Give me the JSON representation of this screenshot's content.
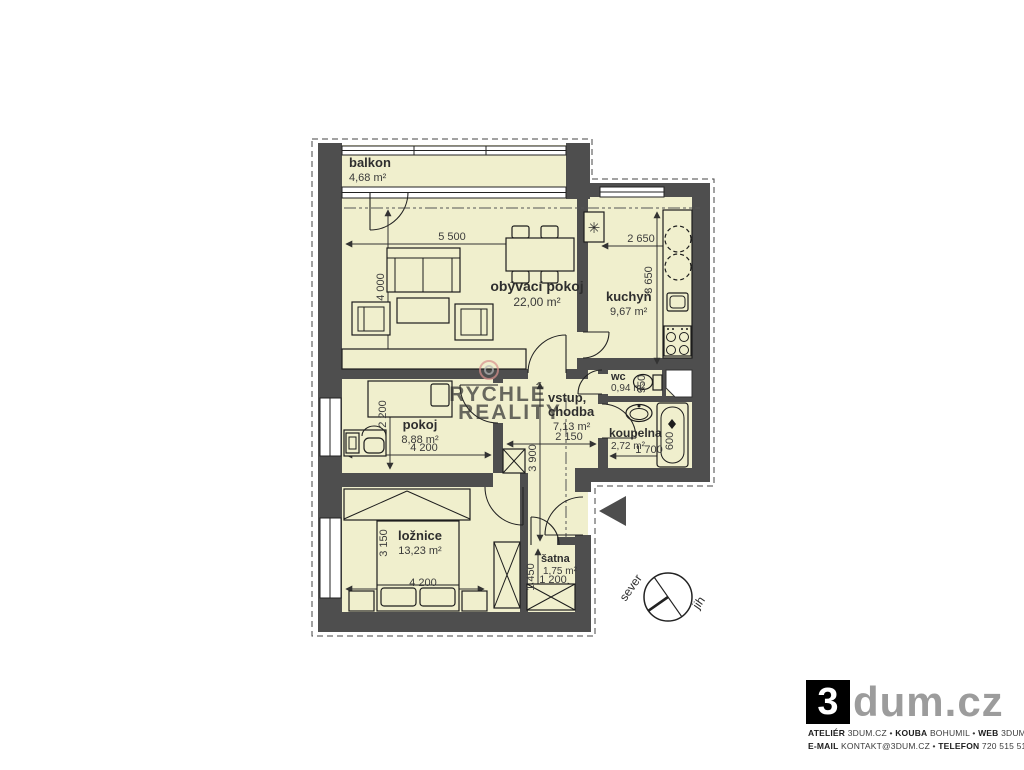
{
  "plan": {
    "balkon": {
      "name": "balkon",
      "area": "4,68 m²"
    },
    "obyvaci": {
      "name": "obývací pokoj",
      "area": "22,00 m²",
      "dim_w": "5 500",
      "dim_h": "4 000"
    },
    "kuchyn": {
      "name": "kuchyň",
      "area": "9,67 m²",
      "dim_w": "2 650",
      "dim_h": "3 650"
    },
    "wc": {
      "name": "wc",
      "area": "0,94 m²",
      "dim_h": "950"
    },
    "koupelna": {
      "name": "koupelna",
      "area": "2,72 m²",
      "dim_w": "1 700",
      "dim_tub": "600"
    },
    "pokoj": {
      "name": "pokoj",
      "area": "8,88 m²",
      "dim_w": "4 200",
      "dim_h": "2 200"
    },
    "chodba": {
      "name_line1": "vstup,",
      "name_line2": "chodba",
      "area": "7,13 m²",
      "dim_w": "2 150",
      "dim_h": "3 900"
    },
    "loznice": {
      "name": "ložnice",
      "area": "13,23 m²",
      "dim_w": "4 200",
      "dim_h": "3 150"
    },
    "satna": {
      "name": "šatna",
      "area": "1,75 m²",
      "dim_w": "1 200",
      "dim_h": "1 450"
    }
  },
  "compass": {
    "north_label": "sever",
    "south_label": "jih"
  },
  "watermark": {
    "word1": "RYCHLÉ",
    "word2": "REALITY"
  },
  "icons": {
    "boiler": "✳"
  },
  "branding": {
    "logo_number": "3",
    "logo_text": "dum.cz",
    "contact": {
      "sep": "•",
      "atelier_label": "ATELIÉR",
      "atelier_value": "3DUM.CZ",
      "kouba_label": "KOUBA",
      "kouba_value": "BOHUMIL",
      "web_label": "WEB",
      "web_value": "3DUM.CZ",
      "email_label": "E-MAIL",
      "email_value": "KONTAKT@3DUM.CZ",
      "telefon_label": "TELEFON",
      "telefon_value": "720 515 510"
    }
  },
  "colors": {
    "room_fill": "#f0efcd",
    "wall": "#4e4e4e",
    "watermark_red": "#d9736f",
    "watermark_gray": "#a0a0a0",
    "logo_gray": "#9c9c9c",
    "entrance_arrow": "#4d4d4d"
  }
}
